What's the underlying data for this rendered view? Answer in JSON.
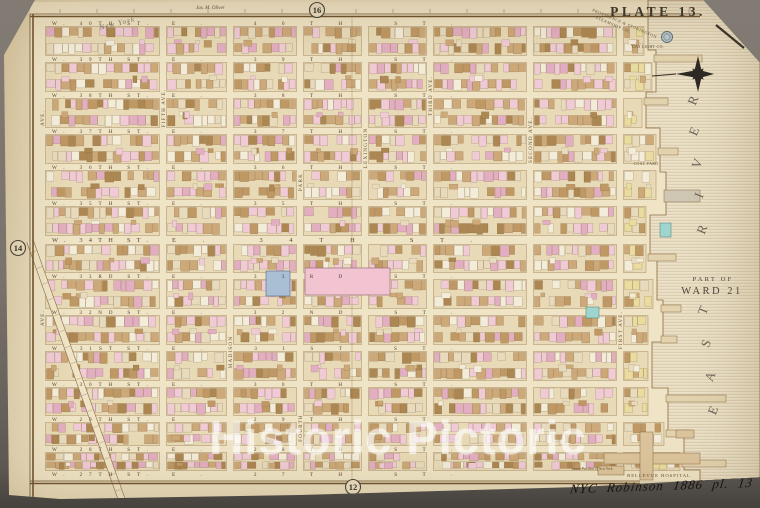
{
  "plate": {
    "title": "PLATE 13."
  },
  "page_refs": {
    "top": "16",
    "left": "14",
    "bottom": "12"
  },
  "margin_notes": {
    "surveyor": "Jas. M. Oliver",
    "pencil": "New York",
    "handwritten": "NYC  Robinson  1886    pl.  13"
  },
  "watermark": {
    "text": "Historic Pictoric"
  },
  "ward": {
    "line1": "PART OF",
    "line2": "WARD 21"
  },
  "river": {
    "name": "EAST RIVER",
    "letters": [
      {
        "ch": "R",
        "x": 697,
        "y": 102
      },
      {
        "ch": "E",
        "x": 698,
        "y": 133
      },
      {
        "ch": "V",
        "x": 701,
        "y": 165
      },
      {
        "ch": "I",
        "x": 703,
        "y": 197
      },
      {
        "ch": "R",
        "x": 706,
        "y": 231
      },
      {
        "ch": "T",
        "x": 707,
        "y": 312
      },
      {
        "ch": "S",
        "x": 710,
        "y": 345
      },
      {
        "ch": "A",
        "x": 714,
        "y": 378
      },
      {
        "ch": "E",
        "x": 717,
        "y": 412
      }
    ]
  },
  "streets": [
    {
      "label_w": "W. 40TH ST.",
      "label_e": "E. 40TH ST.",
      "y": 23,
      "major": false
    },
    {
      "label_w": "W. 39TH ST.",
      "label_e": "E. 39TH ST.",
      "y": 59,
      "major": false
    },
    {
      "label_w": "W. 38TH ST.",
      "label_e": "E. 38TH ST.",
      "y": 95,
      "major": false
    },
    {
      "label_w": "W. 37TH ST.",
      "label_e": "E. 37TH ST.",
      "y": 131,
      "major": false
    },
    {
      "label_w": "W. 36TH ST.",
      "label_e": "E. 36TH ST.",
      "y": 167,
      "major": false
    },
    {
      "label_w": "W. 35TH ST.",
      "label_e": "E. 35TH ST.",
      "y": 203,
      "major": false
    },
    {
      "label_w": "W. 34TH ST.",
      "label_e": "E. 34TH ST.",
      "y": 240,
      "major": true
    },
    {
      "label_w": "W. 33RD ST.",
      "label_e": "E. 33RD ST.",
      "y": 276,
      "major": false
    },
    {
      "label_w": "W. 32ND ST.",
      "label_e": "E. 32ND ST.",
      "y": 312,
      "major": false
    },
    {
      "label_w": "W. 31ST ST.",
      "label_e": "E. 31ST ST.",
      "y": 348,
      "major": false
    },
    {
      "label_w": "W. 30TH ST.",
      "label_e": "E. 30TH ST.",
      "y": 384,
      "major": false
    },
    {
      "label_w": "W. 29TH ST.",
      "label_e": "E. 29TH ST.",
      "y": 419,
      "major": false
    },
    {
      "label_w": "W. 28TH ST.",
      "label_e": "E. 28TH ST.",
      "y": 449,
      "major": false
    },
    {
      "label_w": "W. 27TH ST.",
      "label_e": "E. 27TH ST.",
      "y": 474,
      "major": false
    }
  ],
  "avenues": {
    "xs": [
      42,
      163,
      230,
      300,
      365,
      430,
      530,
      620
    ],
    "labels": [
      {
        "text": "AVE.",
        "x": 42,
        "y": 118
      },
      {
        "text": "AVE.",
        "x": 42,
        "y": 318
      },
      {
        "text": "FIFTH AVE.",
        "x": 163,
        "y": 108
      },
      {
        "text": "MADISON",
        "x": 230,
        "y": 352
      },
      {
        "text": "PARK",
        "x": 300,
        "y": 182
      },
      {
        "text": "FOURTH",
        "x": 300,
        "y": 428
      },
      {
        "text": "LEXINGTON",
        "x": 365,
        "y": 148
      },
      {
        "text": "THIRD AVE.",
        "x": 430,
        "y": 96
      },
      {
        "text": "SECOND AVE.",
        "x": 530,
        "y": 140
      },
      {
        "text": "FIRST AVE.",
        "x": 620,
        "y": 330
      }
    ]
  },
  "broadway": {
    "x1": 30,
    "y1": 241,
    "x2": 124,
    "y2": 506
  },
  "shore_steps": [
    [
      0,
      648
    ],
    [
      50,
      656
    ],
    [
      92,
      646
    ],
    [
      128,
      660
    ],
    [
      172,
      666
    ],
    [
      215,
      650
    ],
    [
      258,
      657
    ],
    [
      300,
      663
    ],
    [
      342,
      652
    ],
    [
      388,
      668
    ],
    [
      436,
      684
    ],
    [
      470,
      700
    ]
  ],
  "piers": [
    [
      55,
      48
    ],
    [
      98,
      24
    ],
    [
      148,
      20
    ],
    [
      190,
      36
    ],
    [
      254,
      28
    ],
    [
      305,
      20
    ],
    [
      336,
      16
    ],
    [
      395,
      60
    ],
    [
      430,
      24
    ],
    [
      460,
      44
    ]
  ],
  "features": {
    "gas_tank_label": "GAS LIGHT CO.",
    "steamship_line1": "PROVIDENCE & STONINGTON",
    "steamship_line2": "STEAMSHIP CO.",
    "coal_yard": "COAL YARD",
    "bellevue": "BELLEVUE HOSPITAL",
    "asylum": "Insane Pavilion of New York"
  },
  "colors": {
    "sheet": "#e9dcbc",
    "street": "#efe4c6",
    "block": "#e8dab6",
    "river_base": "#ece2c8",
    "pink": "#f0cbd6",
    "pink2": "#e3aec2",
    "tan": "#cda878",
    "tan2": "#bf9864",
    "brown": "#ad8752",
    "cream": "#e8dbbd",
    "white": "#f3ecd9",
    "yellow": "#e9dc9e",
    "ink": "#55422c",
    "ave_ink": "#6a5436",
    "dark": "#35302a",
    "pier": "#e2d3ae"
  }
}
